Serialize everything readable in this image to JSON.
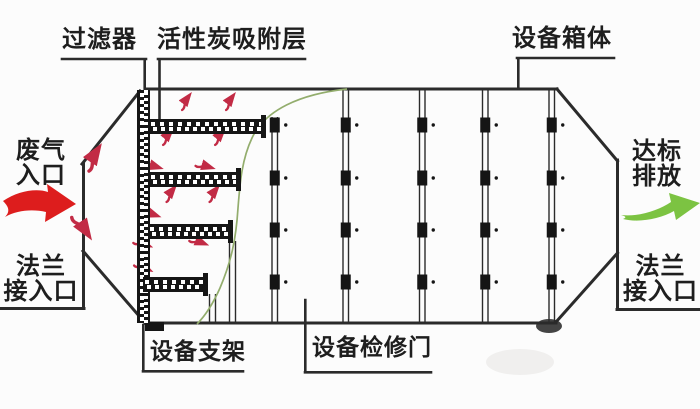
{
  "diagram": {
    "kind": "activated-carbon-adsorption-unit-schematic",
    "labels": {
      "filter": "过滤器",
      "carbon_layer": "活性炭吸附层",
      "cabinet": "设备箱体",
      "waste_gas_inlet": "废气\n入口",
      "flange_inlet": "法兰\n接入口",
      "discharge": "达标\n排放",
      "flange_outlet": "法兰\n接入口",
      "support": "设备支架",
      "access_door": "设备检修门"
    },
    "colors": {
      "line": "#2b2b2b",
      "inlet_arrow": "#dd1d1d",
      "flow_arrow": "#c22b45",
      "outlet_arrow": "#7cc342",
      "divider_curve": "#93ad6d",
      "metal_dark": "#151515"
    }
  }
}
